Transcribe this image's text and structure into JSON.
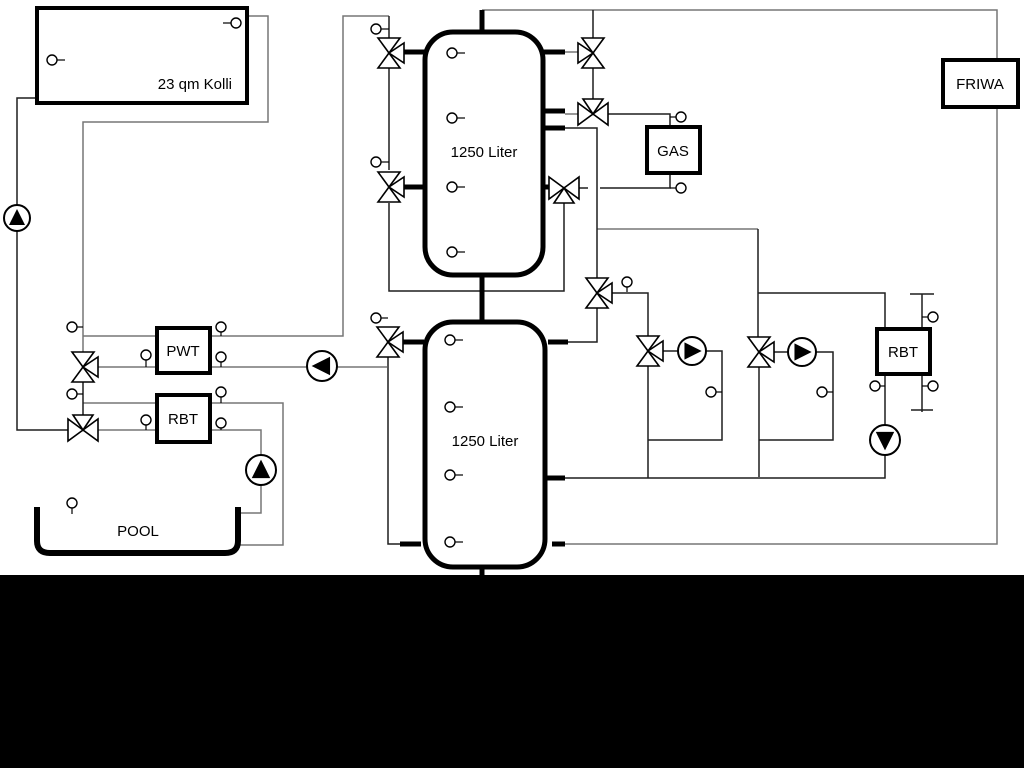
{
  "labels": {
    "collector": "23 qm Kolli",
    "tank_top": "1250 Liter",
    "tank_bottom": "1250 Liter",
    "pwt": "PWT",
    "rbt_left": "RBT",
    "gas": "GAS",
    "friwa": "FRIWA",
    "rbt_right": "RBT",
    "pool": "POOL"
  },
  "colors": {
    "background": "#ffffff",
    "footer_bar": "#000000",
    "pipe_gray": "#767676",
    "pipe_dark": "#1f1f1f",
    "symbol_stroke": "#000000"
  },
  "components": {
    "valves": [
      {
        "id": "valve-solar-mixing",
        "x": 83,
        "y": 367,
        "orient": "v",
        "branch": "right"
      },
      {
        "id": "valve-pool-mixing",
        "x": 83,
        "y": 430,
        "orient": "h",
        "branch": "top"
      },
      {
        "id": "valve-tank1-left-top",
        "x": 389,
        "y": 53,
        "orient": "v",
        "branch": "right"
      },
      {
        "id": "valve-tank1-left-mid",
        "x": 389,
        "y": 187,
        "orient": "v",
        "branch": "right"
      },
      {
        "id": "valve-tank1-right-top",
        "x": 593,
        "y": 53,
        "orient": "v",
        "branch": "left"
      },
      {
        "id": "valve-gas-supply",
        "x": 593,
        "y": 114,
        "orient": "h",
        "branch": "top"
      },
      {
        "id": "valve-tank1-right-low",
        "x": 564,
        "y": 188,
        "orient": "h",
        "branch": "bottom"
      },
      {
        "id": "valve-mid-distribution",
        "x": 597,
        "y": 293,
        "orient": "v",
        "branch": "right"
      },
      {
        "id": "valve-tank2-left-top",
        "x": 388,
        "y": 342,
        "orient": "v",
        "branch": "right"
      },
      {
        "id": "valve-heating-circuit-1",
        "x": 648,
        "y": 351,
        "orient": "v",
        "branch": "right"
      },
      {
        "id": "valve-heating-circuit-2",
        "x": 759,
        "y": 352,
        "orient": "v",
        "branch": "right"
      }
    ],
    "pumps": [
      {
        "id": "pump-solar",
        "x": 17,
        "y": 218,
        "r": 13,
        "dir": "up"
      },
      {
        "id": "pump-pwt",
        "x": 322,
        "y": 366,
        "r": 15,
        "dir": "left"
      },
      {
        "id": "pump-pool",
        "x": 261,
        "y": 470,
        "r": 15,
        "dir": "up"
      },
      {
        "id": "pump-heating-circuit-1",
        "x": 692,
        "y": 351,
        "r": 14,
        "dir": "right"
      },
      {
        "id": "pump-heating-circuit-2",
        "x": 802,
        "y": 352,
        "r": 14,
        "dir": "right"
      },
      {
        "id": "pump-rbt-right",
        "x": 885,
        "y": 440,
        "r": 15,
        "dir": "down"
      }
    ],
    "sensors": [
      {
        "id": "sensor-collector-left",
        "x": 52,
        "y": 60,
        "tick": [
          57,
          60,
          65,
          60
        ]
      },
      {
        "id": "sensor-collector-top",
        "x": 236,
        "y": 23,
        "tick": [
          223,
          23,
          231,
          23
        ]
      },
      {
        "id": "sensor-solar-line-upper",
        "x": 72,
        "y": 327,
        "tick": [
          77,
          327,
          83,
          327
        ]
      },
      {
        "id": "sensor-solar-line-lower",
        "x": 72,
        "y": 394,
        "tick": [
          77,
          394,
          83,
          394
        ]
      },
      {
        "id": "sensor-pwt-in",
        "x": 146,
        "y": 355,
        "tick": [
          146,
          360,
          146,
          367
        ]
      },
      {
        "id": "sensor-pwt-out-upper",
        "x": 221,
        "y": 327,
        "tick": [
          221,
          332,
          221,
          336
        ]
      },
      {
        "id": "sensor-pwt-out-lower",
        "x": 221,
        "y": 357,
        "tick": [
          221,
          362,
          221,
          367
        ]
      },
      {
        "id": "sensor-rbt-left-upper",
        "x": 221,
        "y": 392,
        "tick": [
          221,
          397,
          221,
          403
        ]
      },
      {
        "id": "sensor-rbt-left-in",
        "x": 146,
        "y": 420,
        "tick": [
          146,
          425,
          146,
          430
        ]
      },
      {
        "id": "sensor-rbt-left-lower",
        "x": 221,
        "y": 423,
        "tick": [
          221,
          428,
          221,
          430
        ]
      },
      {
        "id": "sensor-tank1-valve-top",
        "x": 376,
        "y": 29,
        "tick": [
          381,
          29,
          389,
          29
        ]
      },
      {
        "id": "sensor-tank1-valve-mid",
        "x": 376,
        "y": 162,
        "tick": [
          381,
          162,
          389,
          162
        ]
      },
      {
        "id": "sensor-tank2-valve",
        "x": 376,
        "y": 318,
        "tick": [
          381,
          318,
          388,
          318
        ]
      },
      {
        "id": "sensor-gas-top",
        "x": 681,
        "y": 117,
        "tick": [
          670,
          117,
          676,
          117
        ]
      },
      {
        "id": "sensor-gas-bottom",
        "x": 681,
        "y": 188,
        "tick": [
          670,
          188,
          676,
          188
        ]
      },
      {
        "id": "sensor-mid-valve",
        "x": 627,
        "y": 282,
        "tick": [
          627,
          287,
          627,
          292
        ]
      },
      {
        "id": "sensor-heating-circuit-1",
        "x": 711,
        "y": 392,
        "tick": [
          716,
          392,
          722,
          392
        ]
      },
      {
        "id": "sensor-heating-circuit-2",
        "x": 822,
        "y": 392,
        "tick": [
          827,
          392,
          833,
          392
        ]
      },
      {
        "id": "sensor-separator-top",
        "x": 933,
        "y": 317,
        "tick": [
          922,
          317,
          928,
          317
        ]
      },
      {
        "id": "sensor-separator-bottom",
        "x": 933,
        "y": 386,
        "tick": [
          922,
          386,
          928,
          386
        ]
      },
      {
        "id": "sensor-rbt-right",
        "x": 875,
        "y": 386,
        "tick": [
          880,
          386,
          885,
          386
        ]
      },
      {
        "id": "sensor-pool",
        "x": 72,
        "y": 503,
        "tick": [
          72,
          508,
          72,
          514
        ]
      },
      {
        "id": "sensor-tank1-1",
        "x": 452,
        "y": 53,
        "tick": [
          457,
          53,
          465,
          53
        ]
      },
      {
        "id": "sensor-tank1-2",
        "x": 452,
        "y": 118,
        "tick": [
          457,
          118,
          465,
          118
        ]
      },
      {
        "id": "sensor-tank1-3",
        "x": 452,
        "y": 187,
        "tick": [
          457,
          187,
          465,
          187
        ]
      },
      {
        "id": "sensor-tank1-4",
        "x": 452,
        "y": 252,
        "tick": [
          457,
          252,
          465,
          252
        ]
      },
      {
        "id": "sensor-tank2-1",
        "x": 450,
        "y": 340,
        "tick": [
          455,
          340,
          463,
          340
        ]
      },
      {
        "id": "sensor-tank2-2",
        "x": 450,
        "y": 407,
        "tick": [
          455,
          407,
          463,
          407
        ]
      },
      {
        "id": "sensor-tank2-3",
        "x": 450,
        "y": 475,
        "tick": [
          455,
          475,
          463,
          475
        ]
      },
      {
        "id": "sensor-tank2-4",
        "x": 450,
        "y": 542,
        "tick": [
          455,
          542,
          463,
          542
        ]
      }
    ]
  }
}
